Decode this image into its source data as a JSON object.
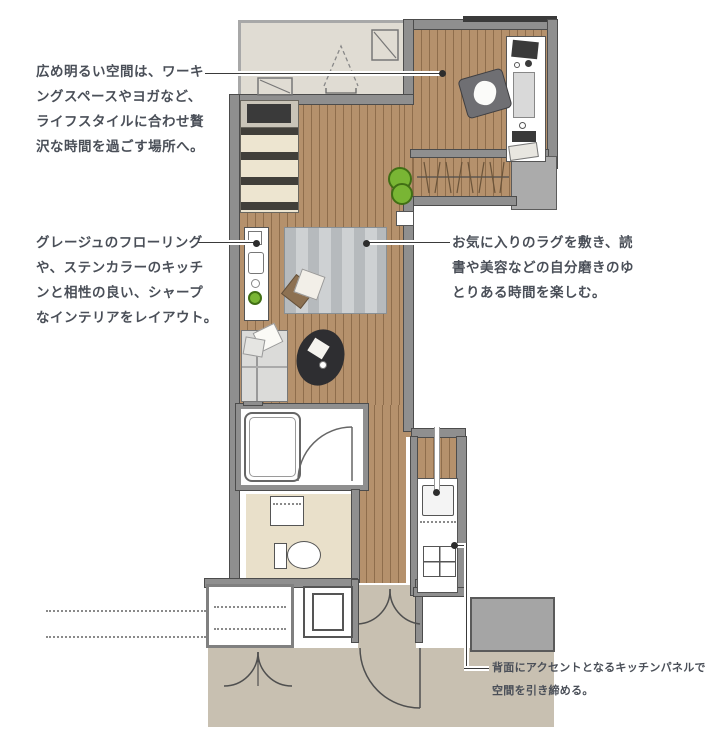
{
  "annotations": {
    "workspace": {
      "lines": [
        "広め明るい空間は、ワーキ",
        "ングスペースやヨガなど、",
        "ライフスタイルに合わせ贅",
        "沢な時間を過ごす場所へ。"
      ]
    },
    "interior": {
      "lines": [
        "グレージュのフローリング",
        "や、ステンカラーのキッチ",
        "ンと相性の良い、シャープ",
        "なインテリアをレイアウト。"
      ]
    },
    "rug": {
      "lines": [
        "お気に入りのラグを敷き、読",
        "書や美容などの自分磨きのゆ",
        "とりある時間を楽しむ。"
      ]
    },
    "kitchen_panel": {
      "lines": [
        "背面にアクセントとなるキッチンパネルで",
        "空間を引き締める。"
      ]
    }
  },
  "colors": {
    "wood_floor": "#b5916c",
    "wall": "#8f8f8f",
    "balcony_floor": "#e0dcd3",
    "exterior_common": "#c8c0b1",
    "sanitary_floor": "#e9e0ca",
    "rug": "#c6c9cb",
    "plant_green": "#79b534",
    "annotation_text": "#4a4f58"
  }
}
